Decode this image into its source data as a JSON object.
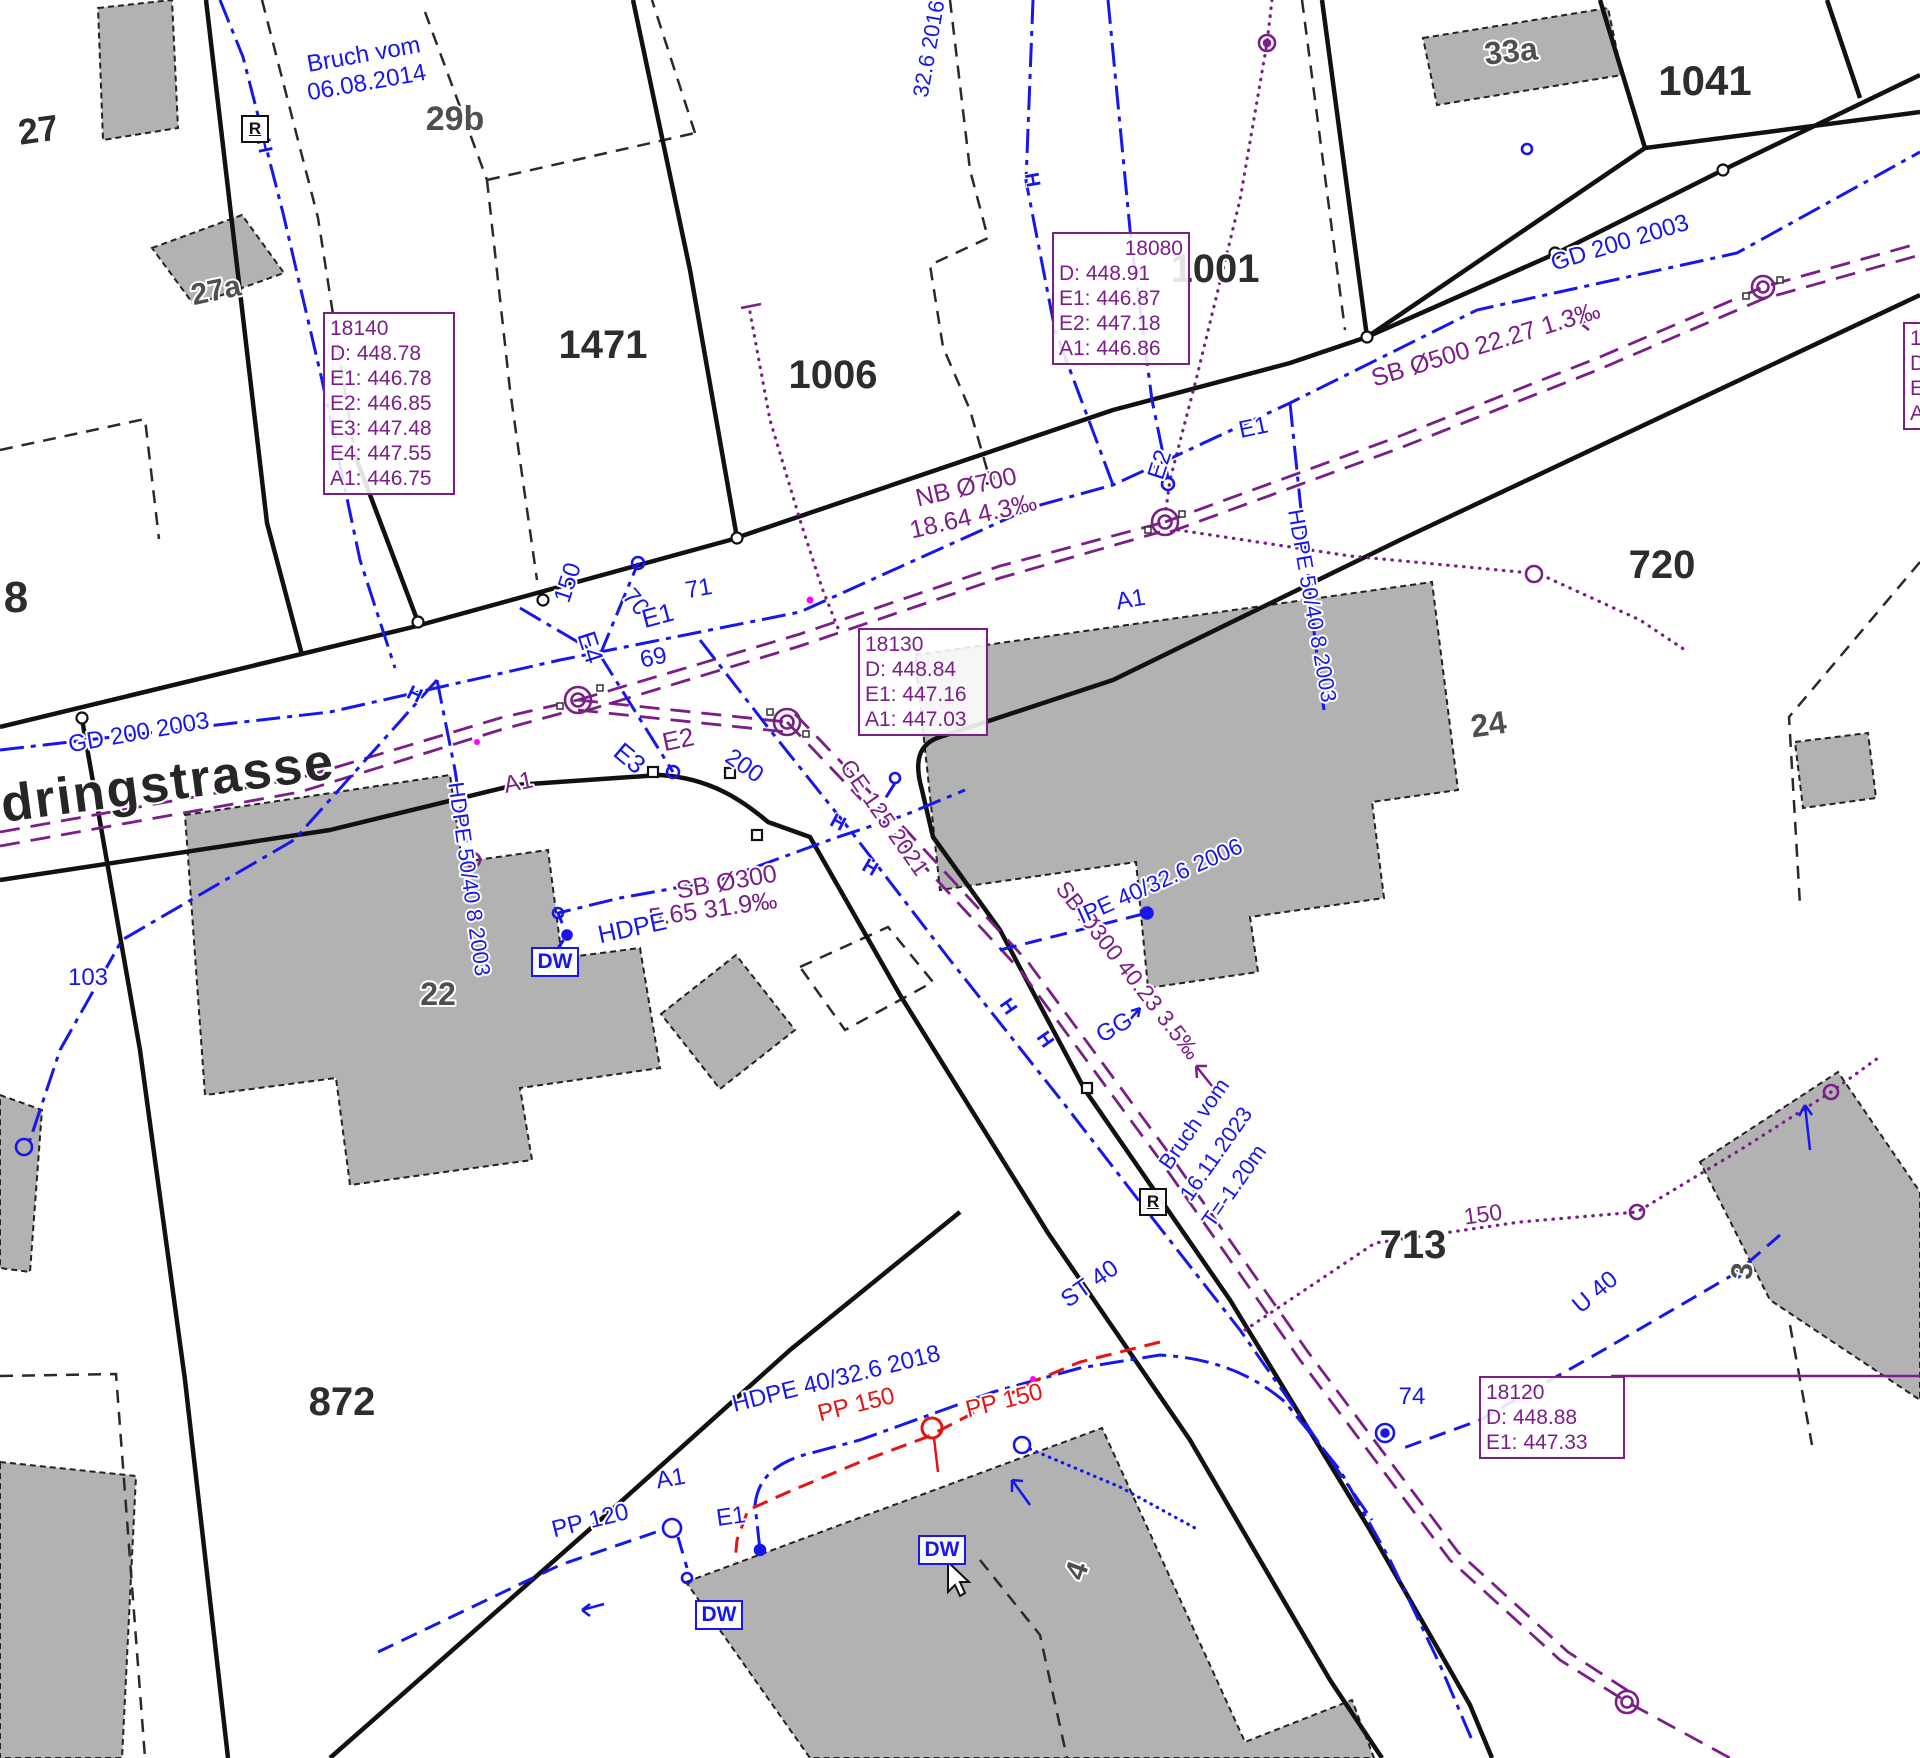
{
  "map_title": "Leitungskataster Ausschnitt",
  "street": {
    "name_fragment": "dringstrasse"
  },
  "colors": {
    "water_blue": "#1717ec",
    "sewer_purple": "#7a1f87",
    "pp_red": "#e51414",
    "parcel_black": "#111111",
    "building_gray": "#b2b2b2",
    "magenta_node": "#ff00ff"
  },
  "info_boxes": [
    {
      "id": "18140",
      "x": 323,
      "y": 312,
      "w": 118,
      "title_align": "left",
      "lines": [
        "18140",
        "D: 448.78",
        "E1: 446.78",
        "E2: 446.85",
        "E3: 447.48",
        "E4: 447.55",
        "A1: 446.75"
      ]
    },
    {
      "id": "18080",
      "x": 1052,
      "y": 232,
      "w": 124,
      "title_align": "right",
      "lines": [
        "18080",
        "D: 448.91",
        "E1: 446.87",
        "E2: 447.18",
        "A1: 446.86"
      ]
    },
    {
      "id": "18130",
      "x": 858,
      "y": 628,
      "w": 116,
      "title_align": "left",
      "lines": [
        "18130",
        "D: 448.84",
        "E1: 447.16",
        "A1: 447.03"
      ]
    },
    {
      "id": "18120",
      "x": 1479,
      "y": 1376,
      "w": 132,
      "title_align": "left",
      "lines": [
        "18120",
        "D: 448.88",
        "E1: 447.33"
      ]
    },
    {
      "id": "edge-partial",
      "x": 1903,
      "y": 322,
      "w": 70,
      "title_align": "left",
      "lines": [
        "1",
        "D",
        "E",
        "A"
      ]
    }
  ],
  "symbol_boxes": [
    {
      "kind": "r",
      "text": "R",
      "x": 253,
      "y": 127
    },
    {
      "kind": "r",
      "text": "R",
      "x": 1151,
      "y": 1200
    },
    {
      "kind": "dw",
      "text": "DW",
      "x": 553,
      "y": 960
    },
    {
      "kind": "dw",
      "text": "DW",
      "x": 717,
      "y": 1613
    },
    {
      "kind": "dw",
      "text": "DW",
      "x": 940,
      "y": 1548
    }
  ],
  "valves": [
    {
      "t": "H",
      "x": 1026,
      "y": 181,
      "r": 80
    },
    {
      "t": "H",
      "x": 412,
      "y": 700,
      "r": 25
    },
    {
      "t": "H",
      "x": 258,
      "y": 147,
      "r": 78
    },
    {
      "t": "H",
      "x": 835,
      "y": 828,
      "r": 28
    },
    {
      "t": "H",
      "x": 867,
      "y": 873,
      "r": 30
    },
    {
      "t": "H",
      "x": 1003,
      "y": 1010,
      "r": 55
    },
    {
      "t": "H",
      "x": 1040,
      "y": 1043,
      "r": 55
    }
  ],
  "labels": [
    {
      "t": "Bruch vom",
      "x": 365,
      "y": 62,
      "r": -10,
      "c": "blue",
      "s": 24
    },
    {
      "t": "06.08.2014",
      "x": 368,
      "y": 90,
      "r": -10,
      "c": "blue",
      "s": 24
    },
    {
      "t": "27",
      "x": 40,
      "y": 142,
      "r": -8,
      "c": "parcel",
      "s": 36
    },
    {
      "t": "27a",
      "x": 218,
      "y": 300,
      "r": -12,
      "c": "bld",
      "s": 30
    },
    {
      "t": "29b",
      "x": 455,
      "y": 130,
      "r": 0,
      "c": "bld",
      "s": 34
    },
    {
      "t": "1471",
      "x": 603,
      "y": 358,
      "r": 0,
      "c": "parcel",
      "s": 40
    },
    {
      "t": "1006",
      "x": 833,
      "y": 388,
      "r": 0,
      "c": "parcel",
      "s": 40
    },
    {
      "t": "1041",
      "x": 1705,
      "y": 95,
      "r": 0,
      "c": "parcel",
      "s": 42
    },
    {
      "t": "33a",
      "x": 1512,
      "y": 62,
      "r": -6,
      "c": "bld",
      "s": 32
    },
    {
      "t": "1001",
      "x": 1215,
      "y": 282,
      "r": 0,
      "c": "parcel",
      "s": 40
    },
    {
      "t": "720",
      "x": 1662,
      "y": 578,
      "r": 0,
      "c": "parcel",
      "s": 40
    },
    {
      "t": "872",
      "x": 342,
      "y": 1415,
      "r": 0,
      "c": "parcel",
      "s": 40
    },
    {
      "t": "713",
      "x": 1413,
      "y": 1258,
      "r": 0,
      "c": "parcel",
      "s": 40
    },
    {
      "t": "8",
      "x": 16,
      "y": 612,
      "r": 0,
      "c": "parcel",
      "s": 44
    },
    {
      "t": "22",
      "x": 438,
      "y": 1005,
      "r": 0,
      "c": "bld",
      "s": 32
    },
    {
      "t": "24",
      "x": 1490,
      "y": 735,
      "r": -8,
      "c": "bld",
      "s": 32
    },
    {
      "t": "4",
      "x": 1086,
      "y": 1574,
      "r": -70,
      "c": "bld",
      "s": 30
    },
    {
      "t": "3",
      "x": 1752,
      "y": 1272,
      "r": -85,
      "c": "bld",
      "s": 30
    },
    {
      "t": "74",
      "x": 1412,
      "y": 1404,
      "r": 0,
      "c": "blue",
      "s": 24
    },
    {
      "t": "103",
      "x": 88,
      "y": 985,
      "r": 0,
      "c": "blue",
      "s": 24
    },
    {
      "t": "dringstrasse",
      "x": 170,
      "y": 800,
      "r": -7.5,
      "c": "street",
      "s": 52
    },
    {
      "t": "GD 200  2003",
      "x": 140,
      "y": 740,
      "r": -10,
      "c": "blue",
      "s": 24
    },
    {
      "t": "GD 200  2003",
      "x": 1622,
      "y": 250,
      "r": -17,
      "c": "blue",
      "s": 24
    },
    {
      "t": "SB Ø500 22.27 1.3‰",
      "x": 1488,
      "y": 352,
      "r": -17,
      "c": "purple",
      "s": 25
    },
    {
      "t": "NB Ø700",
      "x": 968,
      "y": 495,
      "r": -13,
      "c": "purple",
      "s": 25
    },
    {
      "t": "18.64 4.3‰",
      "x": 975,
      "y": 524,
      "r": -13,
      "c": "purple",
      "s": 25
    },
    {
      "t": "E1",
      "x": 1255,
      "y": 435,
      "r": -12,
      "c": "blue",
      "s": 24
    },
    {
      "t": "E2",
      "x": 1167,
      "y": 467,
      "r": -72,
      "c": "blue",
      "s": 24
    },
    {
      "t": "HDPE 50/40 8  2003",
      "x": 1305,
      "y": 607,
      "r": 80,
      "c": "blue",
      "s": 22
    },
    {
      "t": "HDPE 50/40 8  2003",
      "x": 462,
      "y": 880,
      "r": 82,
      "c": "blue",
      "s": 22
    },
    {
      "t": "150",
      "x": 575,
      "y": 585,
      "r": -72,
      "c": "blue",
      "s": 24
    },
    {
      "t": "70",
      "x": 630,
      "y": 607,
      "r": 50,
      "c": "blue",
      "s": 24
    },
    {
      "t": "71",
      "x": 700,
      "y": 596,
      "r": -10,
      "c": "blue",
      "s": 24
    },
    {
      "t": "E1",
      "x": 660,
      "y": 624,
      "r": -15,
      "c": "blue",
      "s": 26
    },
    {
      "t": "E4",
      "x": 582,
      "y": 650,
      "r": 72,
      "c": "blue",
      "s": 26
    },
    {
      "t": "69",
      "x": 655,
      "y": 665,
      "r": -12,
      "c": "blue",
      "s": 24
    },
    {
      "t": "E3",
      "x": 624,
      "y": 765,
      "r": 40,
      "c": "blue",
      "s": 26
    },
    {
      "t": "E2",
      "x": 680,
      "y": 748,
      "r": -12,
      "c": "purple",
      "s": 26
    },
    {
      "t": "200",
      "x": 740,
      "y": 772,
      "r": 35,
      "c": "blue",
      "s": 24
    },
    {
      "t": "A1",
      "x": 520,
      "y": 790,
      "r": -12,
      "c": "purple",
      "s": 24
    },
    {
      "t": "A1",
      "x": 1132,
      "y": 607,
      "r": -10,
      "c": "blue",
      "s": 24
    },
    {
      "t": "SB Ø300",
      "x": 728,
      "y": 890,
      "r": -10,
      "c": "purple",
      "s": 25
    },
    {
      "t": "5.65 31.9‰",
      "x": 714,
      "y": 917,
      "r": -8,
      "c": "purple",
      "s": 25
    },
    {
      "t": "HDPE",
      "x": 634,
      "y": 936,
      "r": -12,
      "c": "blue",
      "s": 25
    },
    {
      "t": "GE 125  2021",
      "x": 878,
      "y": 822,
      "r": 55,
      "c": "purple",
      "s": 23
    },
    {
      "t": "SB Ø300 40.23 3.5‰",
      "x": 1122,
      "y": 975,
      "r": 52,
      "c": "purple",
      "s": 23
    },
    {
      "t": "IPE 40/32.6  2006",
      "x": 1163,
      "y": 888,
      "r": -24,
      "c": "blue",
      "s": 23
    },
    {
      "t": "GG",
      "x": 1118,
      "y": 1034,
      "r": -30,
      "c": "blue",
      "s": 24
    },
    {
      "t": "Bruch vom",
      "x": 1200,
      "y": 1128,
      "r": -55,
      "c": "blue",
      "s": 22
    },
    {
      "t": "16.11.2023",
      "x": 1222,
      "y": 1158,
      "r": -55,
      "c": "blue",
      "s": 22
    },
    {
      "t": "T=-1.20m",
      "x": 1240,
      "y": 1190,
      "r": -55,
      "c": "blue",
      "s": 22
    },
    {
      "t": "150",
      "x": 1484,
      "y": 1222,
      "r": -8,
      "c": "purple",
      "s": 23
    },
    {
      "t": "U 40",
      "x": 1600,
      "y": 1298,
      "r": -40,
      "c": "blue",
      "s": 24
    },
    {
      "t": "ST 40",
      "x": 1094,
      "y": 1290,
      "r": -35,
      "c": "blue",
      "s": 24
    },
    {
      "t": "HDPE 40/32.6  2018",
      "x": 838,
      "y": 1386,
      "r": -14,
      "c": "blue",
      "s": 24
    },
    {
      "t": "PP 150",
      "x": 858,
      "y": 1412,
      "r": -14,
      "c": "red",
      "s": 24
    },
    {
      "t": "PP 150",
      "x": 1006,
      "y": 1408,
      "r": -14,
      "c": "red",
      "s": 24
    },
    {
      "t": "PP 120",
      "x": 592,
      "y": 1528,
      "r": -14,
      "c": "blue",
      "s": 24
    },
    {
      "t": "A1",
      "x": 672,
      "y": 1486,
      "r": -10,
      "c": "blue",
      "s": 24
    },
    {
      "t": "E1",
      "x": 732,
      "y": 1524,
      "r": -8,
      "c": "blue",
      "s": 24
    },
    {
      "t": "32.6  2016",
      "x": 936,
      "y": 50,
      "r": -80,
      "c": "blue",
      "s": 22
    }
  ]
}
